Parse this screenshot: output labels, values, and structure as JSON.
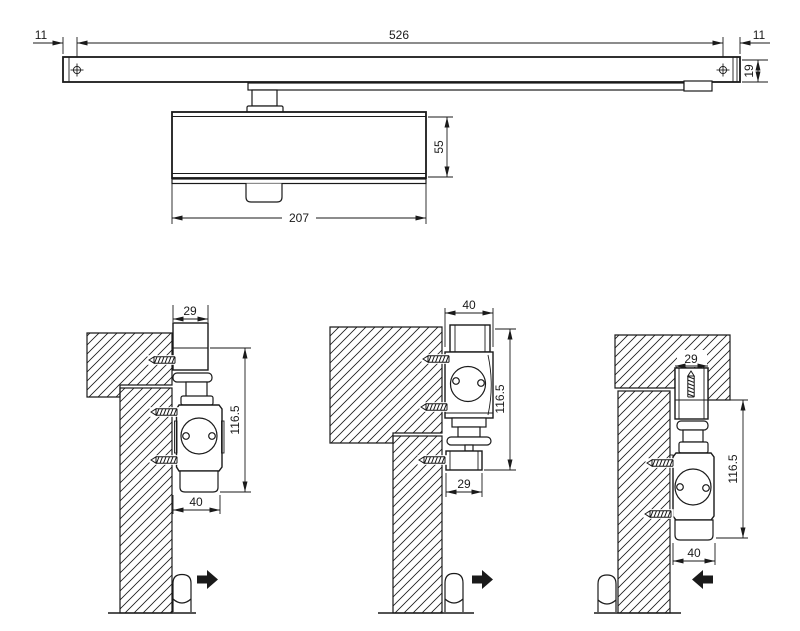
{
  "drawing": {
    "colors": {
      "line": "#1a1a1a",
      "background": "#ffffff"
    },
    "top_view": {
      "dims": {
        "left_end_to_hole": "11",
        "hole_spacing": "526",
        "hole_to_right_end": "11",
        "rail_height": "19",
        "body_height": "55",
        "body_length": "207"
      }
    },
    "installation_views": [
      {
        "dims": {
          "rail_depth": "29",
          "mount_height": "116.5",
          "body_depth": "40"
        },
        "door_swing": "right"
      },
      {
        "dims": {
          "body_depth": "40",
          "mount_height": "116.5",
          "rail_depth": "29"
        },
        "door_swing": "right"
      },
      {
        "dims": {
          "rail_depth": "29",
          "mount_height": "116.5",
          "body_depth": "40"
        },
        "door_swing": "left"
      }
    ]
  }
}
